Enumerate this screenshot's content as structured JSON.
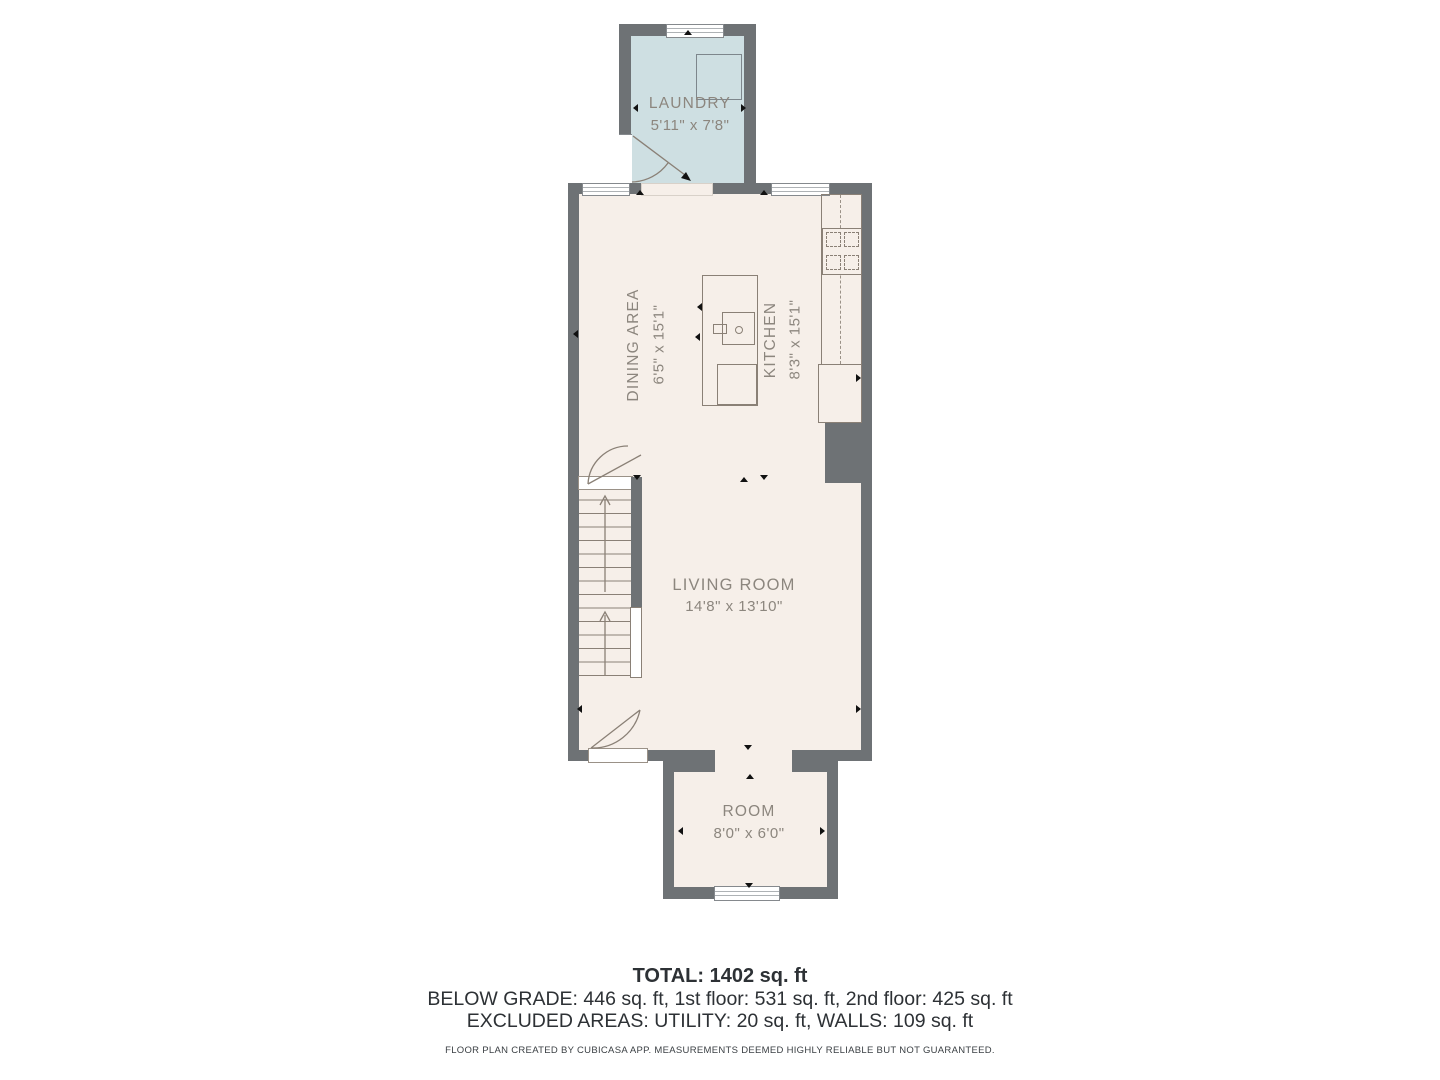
{
  "colors": {
    "wall": "#6e7275",
    "floor": "#f6efe9",
    "laundry": "#cedfe2",
    "line": "#8a8076",
    "label": "#8c867e",
    "ink": "#2d3135"
  },
  "rooms": [
    {
      "name": "LAUNDRY",
      "dims": "5'11\" x 7'8\""
    },
    {
      "name": "DINING AREA",
      "dims": "6'5\" x 15'1\""
    },
    {
      "name": "KITCHEN",
      "dims": "8'3\" x 15'1\""
    },
    {
      "name": "LIVING ROOM",
      "dims": "14'8\" x 13'10\""
    },
    {
      "name": "ROOM",
      "dims": "8'0\" x 6'0\""
    }
  ],
  "summary": {
    "total": "TOTAL: 1402 sq. ft",
    "floors": "BELOW GRADE: 446 sq. ft, 1st floor: 531 sq. ft, 2nd floor: 425 sq. ft",
    "excluded": "EXCLUDED AREAS: UTILITY: 20 sq. ft, WALLS: 109 sq. ft",
    "disclaimer": "FLOOR PLAN CREATED BY CUBICASA APP. MEASUREMENTS DEEMED HIGHLY RELIABLE BUT NOT GUARANTEED."
  },
  "icons": {
    "washer": "square appliance outline",
    "stove": "four-burner cooktop",
    "sink": "island sink with faucet",
    "refrigerator": "rectangle outline",
    "stairs": "stair flights with up arrows",
    "door_swing": "quarter-arc door",
    "window": "double-line window",
    "opening_marker": "small black triangle"
  }
}
